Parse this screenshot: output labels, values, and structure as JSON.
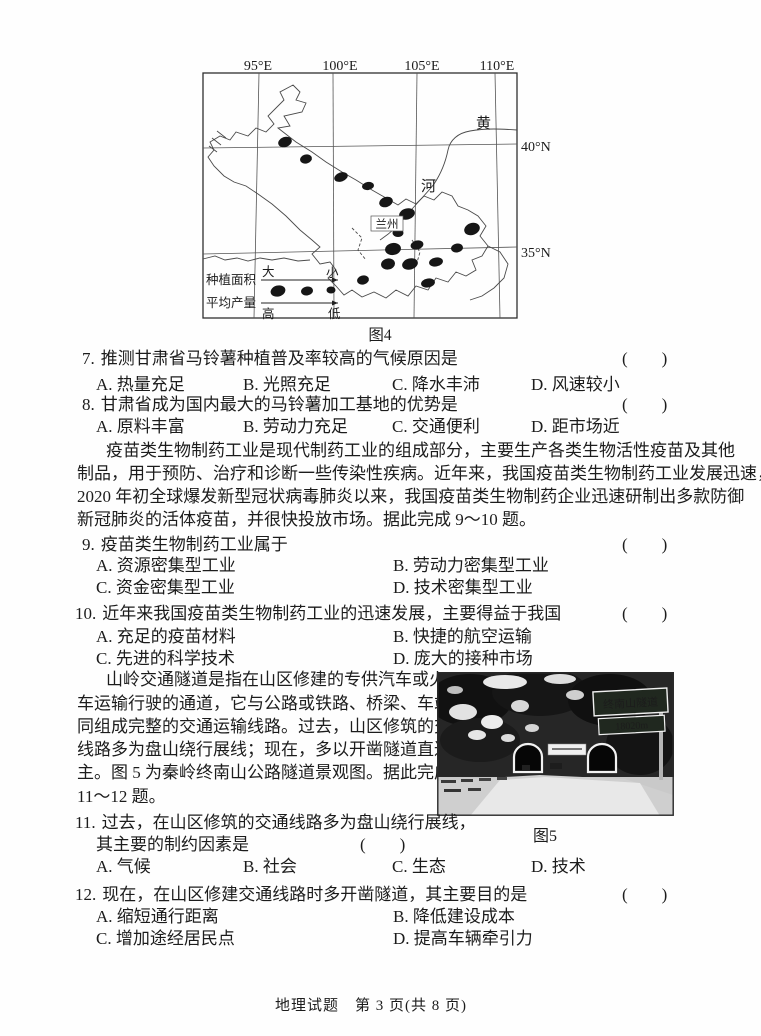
{
  "figure4": {
    "caption": "图4",
    "lon_labels": [
      "95°E",
      "100°E",
      "105°E",
      "110°E"
    ],
    "lat_labels": [
      "40°N",
      "35°N"
    ],
    "river_char_top": "黄",
    "river_char_bottom": "河",
    "city": "兰州",
    "legend": {
      "area_label": "种植面积",
      "area_left": "大",
      "area_right": "小",
      "yield_label": "平均产量",
      "yield_left": "高",
      "yield_right": "低"
    }
  },
  "questions": {
    "q7": {
      "number": "7.",
      "stem": "推测甘肃省马铃薯种植普及率较高的气候原因是",
      "bracket": "(　　)",
      "options": [
        "A. 热量充足",
        "B. 光照充足",
        "C. 降水丰沛",
        "D. 风速较小"
      ]
    },
    "q8": {
      "number": "8.",
      "stem": "甘肃省成为国内最大的马铃薯加工基地的优势是",
      "bracket": "(　　)",
      "options": [
        "A. 原料丰富",
        "B. 劳动力充足",
        "C. 交通便利",
        "D. 距市场近"
      ]
    },
    "q9": {
      "number": "9.",
      "stem": "疫苗类生物制药工业属于",
      "bracket": "(　　)",
      "options": [
        "A. 资源密集型工业",
        "B. 劳动力密集型工业",
        "C. 资金密集型工业",
        "D. 技术密集型工业"
      ]
    },
    "q10": {
      "number": "10.",
      "stem": "近年来我国疫苗类生物制药工业的迅速发展，主要得益于我国",
      "bracket": "(　　)",
      "options": [
        "A. 充足的疫苗材料",
        "B. 快捷的航空运输",
        "C. 先进的科学技术",
        "D. 庞大的接种市场"
      ]
    },
    "q11": {
      "number": "11.",
      "stem_line1": "过去，在山区修筑的交通线路多为盘山绕行展线，",
      "stem_line2": "其主要的制约因素是",
      "bracket": "(　　)",
      "options": [
        "A. 气候",
        "B. 社会",
        "C. 生态",
        "D. 技术"
      ]
    },
    "q12": {
      "number": "12.",
      "stem": "现在，在山区修建交通线路时多开凿隧道，其主要目的是",
      "bracket": "(　　)",
      "options": [
        "A. 缩短通行距离",
        "B. 降低建设成本",
        "C. 增加途经居民点",
        "D. 提高车辆牵引力"
      ]
    }
  },
  "passage1": {
    "lines": [
      "疫苗类生物制药工业是现代制药工业的组成部分，主要生产各类生物活性疫苗及其他",
      "制品，用于预防、治疗和诊断一些传染性疾病。近年来，我国疫苗类生物制药工业发展迅速，",
      "2020 年初全球爆发新型冠状病毒肺炎以来，我国疫苗类生物制药企业迅速研制出多款防御",
      "新冠肺炎的活体疫苗，并很快投放市场。据此完成 9～10 题。"
    ]
  },
  "passage2": {
    "lines": [
      "山岭交通隧道是指在山区修建的专供汽车或火",
      "车运输行驶的通道，它与公路或铁路、桥梁、车站等共",
      "同组成完整的交通运输线路。过去，山区修筑的交通",
      "线路多为盘山绕行展线；现在，多以开凿隧道直达为",
      "主。图 5 为秦岭终南山公路隧道景观图。据此完成",
      "11～12 题。"
    ]
  },
  "figure5": {
    "caption": "图5",
    "sign_line1": "终南山隧道",
    "sign_line2": "18020m"
  },
  "footer": {
    "text": "地理试题　第 3 页(共 8 页)"
  }
}
